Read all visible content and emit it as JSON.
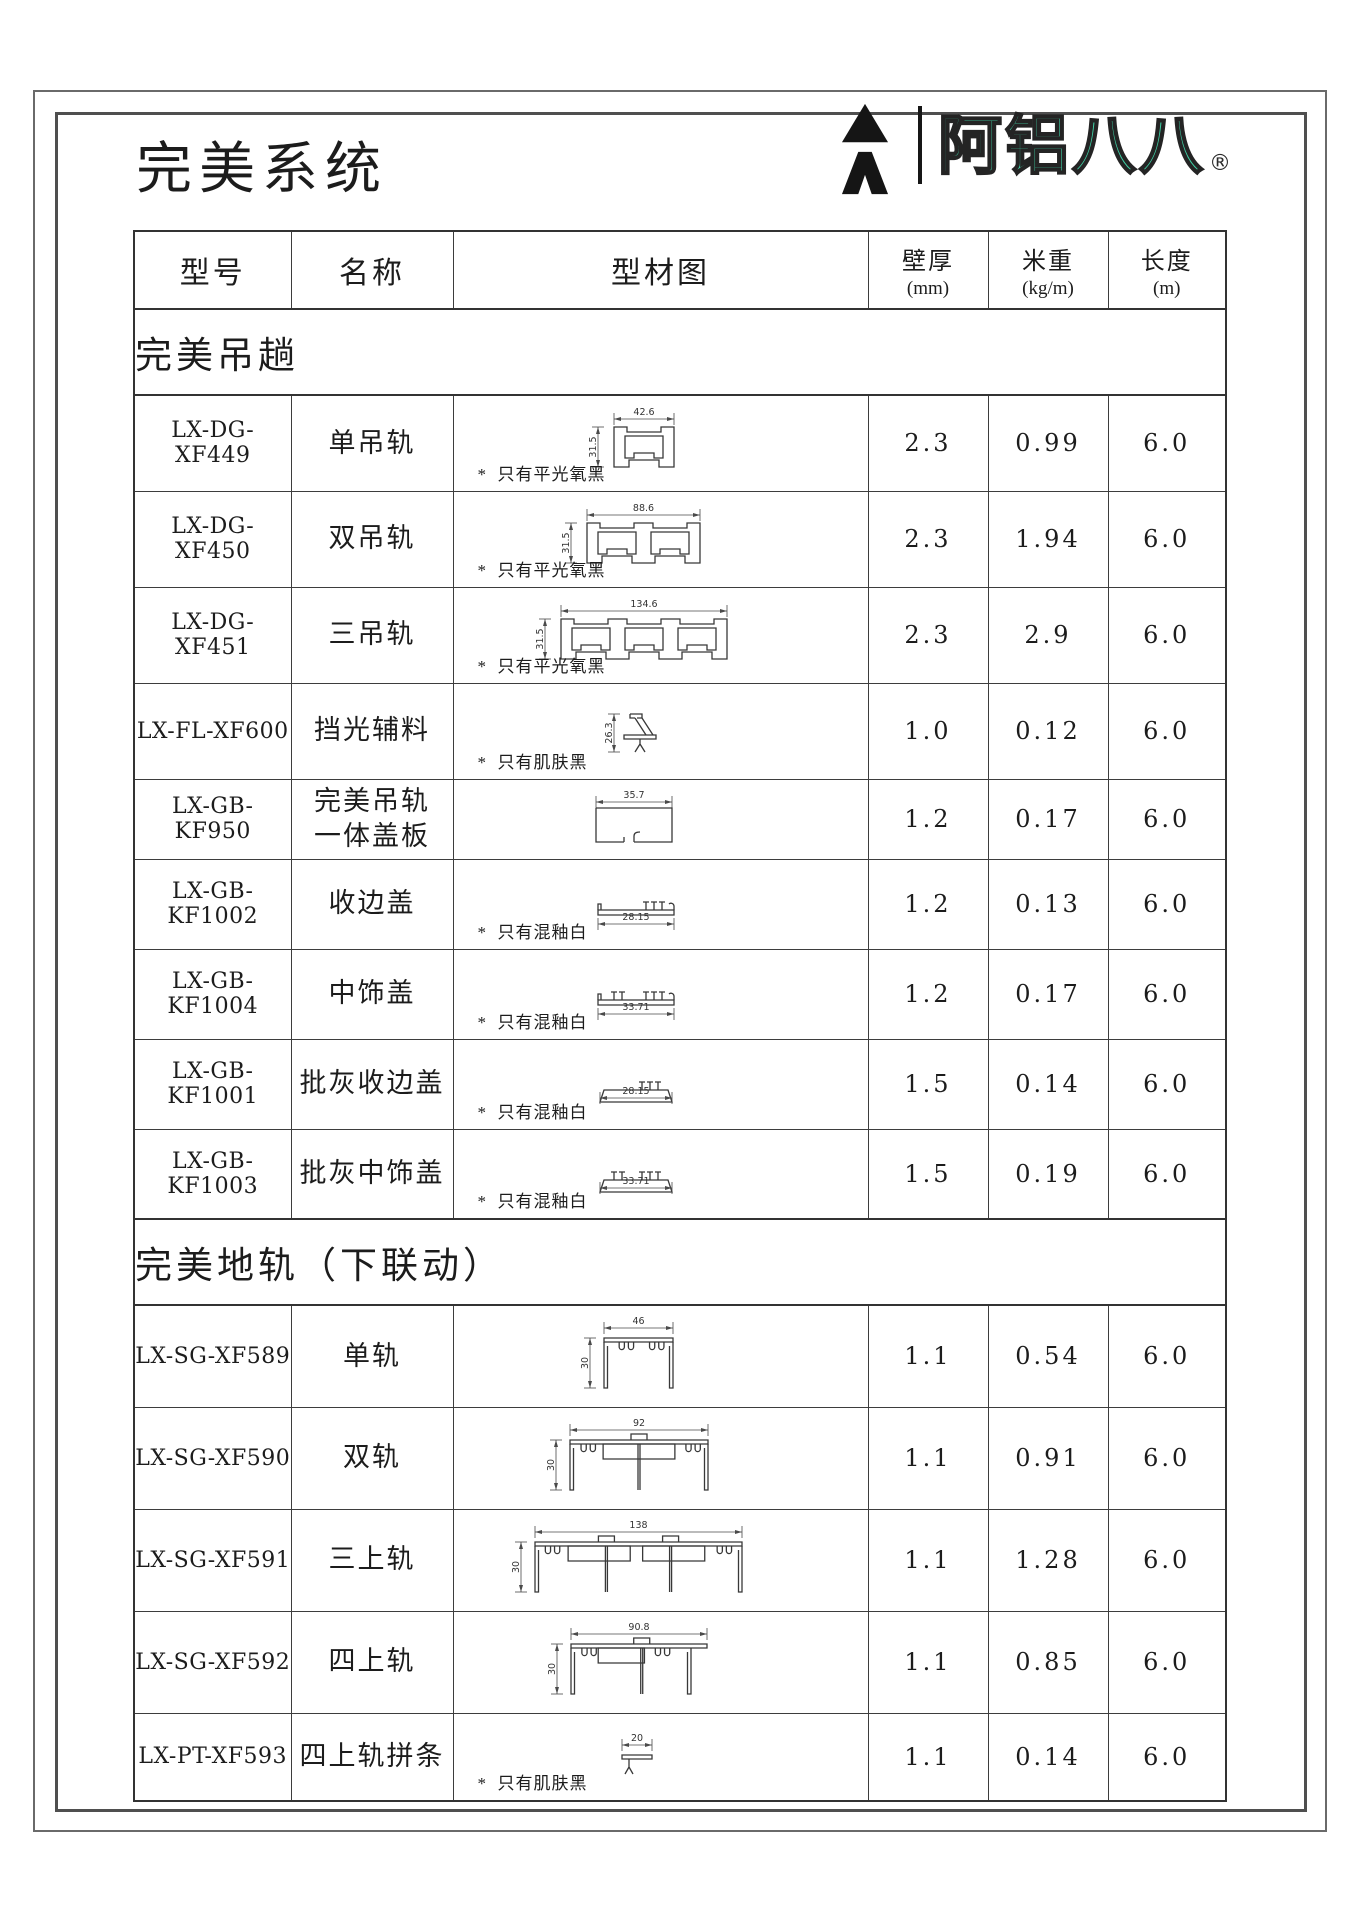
{
  "page": {
    "title": "完美系统"
  },
  "logo": {
    "brand": "阿铝八八",
    "registered": "®",
    "accent_color": "#40d3a7"
  },
  "table": {
    "header": {
      "model": "型号",
      "name": "名称",
      "diagram": "型材图",
      "wall": "壁厚",
      "wall_unit": "(mm)",
      "weight": "米重",
      "weight_unit": "(kg/m)",
      "length": "长度",
      "length_unit": "(m)"
    },
    "sections": [
      {
        "title": "完美吊趟",
        "rows": [
          {
            "model": "LX-DG-XF449",
            "name": "单吊轨",
            "wall": "2.3",
            "weight": "0.99",
            "length": "6.0",
            "note": "*  只有平光氧黑",
            "diagram": {
              "shape": "hang",
              "tracks": 1,
              "dim_top": "42.6",
              "dim_left": "31.5"
            }
          },
          {
            "model": "LX-DG-XF450",
            "name": "双吊轨",
            "wall": "2.3",
            "weight": "1.94",
            "length": "6.0",
            "note": "*  只有平光氧黑",
            "diagram": {
              "shape": "hang",
              "tracks": 2,
              "dim_top": "88.6",
              "dim_left": "31.5"
            }
          },
          {
            "model": "LX-DG-XF451",
            "name": "三吊轨",
            "wall": "2.3",
            "weight": "2.9",
            "length": "6.0",
            "note": "*  只有平光氧黑",
            "diagram": {
              "shape": "hang",
              "tracks": 3,
              "dim_top": "134.6",
              "dim_left": "31.5"
            }
          },
          {
            "model": "LX-FL-XF600",
            "name": "挡光辅料",
            "wall": "1.0",
            "weight": "0.12",
            "length": "6.0",
            "note": "*  只有肌肤黑",
            "diagram": {
              "shape": "baffle",
              "dim_left": "26.3"
            }
          },
          {
            "model": "LX-GB-KF950",
            "name": "完美吊轨",
            "name2": "一体盖板",
            "wall": "1.2",
            "weight": "0.17",
            "length": "6.0",
            "note": "",
            "diagram": {
              "shape": "coverbox",
              "dim_top": "35.7"
            }
          },
          {
            "model": "LX-GB-KF1002",
            "name": "收边盖",
            "wall": "1.2",
            "weight": "0.13",
            "length": "6.0",
            "note": "*  只有混釉白",
            "diagram": {
              "shape": "teeth",
              "clusters": 1,
              "dim_bottom": "28.15"
            }
          },
          {
            "model": "LX-GB-KF1004",
            "name": "中饰盖",
            "wall": "1.2",
            "weight": "0.17",
            "length": "6.0",
            "note": "*  只有混釉白",
            "diagram": {
              "shape": "teeth",
              "clusters": 2,
              "dim_bottom": "33.71"
            }
          },
          {
            "model": "LX-GB-KF1001",
            "name": "批灰收边盖",
            "wall": "1.5",
            "weight": "0.14",
            "length": "6.0",
            "note": "*  只有混釉白",
            "diagram": {
              "shape": "teethtrap",
              "clusters": 1,
              "dim_bottom": "28.15"
            }
          },
          {
            "model": "LX-GB-KF1003",
            "name": "批灰中饰盖",
            "wall": "1.5",
            "weight": "0.19",
            "length": "6.0",
            "note": "*  只有混釉白",
            "diagram": {
              "shape": "teethtrap",
              "clusters": 2,
              "dim_bottom": "33.71"
            }
          }
        ]
      },
      {
        "title": "完美地轨（下联动）",
        "rows": [
          {
            "model": "LX-SG-XF589",
            "name": "单轨",
            "wall": "1.1",
            "weight": "0.54",
            "length": "6.0",
            "note": "",
            "diagram": {
              "shape": "floor",
              "tracks": 1,
              "dim_top": "46",
              "dim_left": "30"
            }
          },
          {
            "model": "LX-SG-XF590",
            "name": "双轨",
            "wall": "1.1",
            "weight": "0.91",
            "length": "6.0",
            "note": "",
            "diagram": {
              "shape": "floor",
              "tracks": 2,
              "dim_top": "92",
              "dim_left": "30"
            }
          },
          {
            "model": "LX-SG-XF591",
            "name": "三上轨",
            "wall": "1.1",
            "weight": "1.28",
            "length": "6.0",
            "note": "",
            "diagram": {
              "shape": "floor",
              "tracks": 3,
              "dim_top": "138",
              "dim_left": "30"
            }
          },
          {
            "model": "LX-SG-XF592",
            "name": "四上轨",
            "wall": "1.1",
            "weight": "0.85",
            "length": "6.0",
            "note": "",
            "diagram": {
              "shape": "floor",
              "tracks": 4,
              "dim_top": "90.8",
              "dim_left": "30"
            }
          },
          {
            "model": "LX-PT-XF593",
            "name": "四上轨拼条",
            "wall": "1.1",
            "weight": "0.14",
            "length": "6.0",
            "note": "*  只有肌肤黑",
            "diagram": {
              "shape": "tstrip",
              "dim_top": "20"
            }
          }
        ]
      }
    ]
  }
}
